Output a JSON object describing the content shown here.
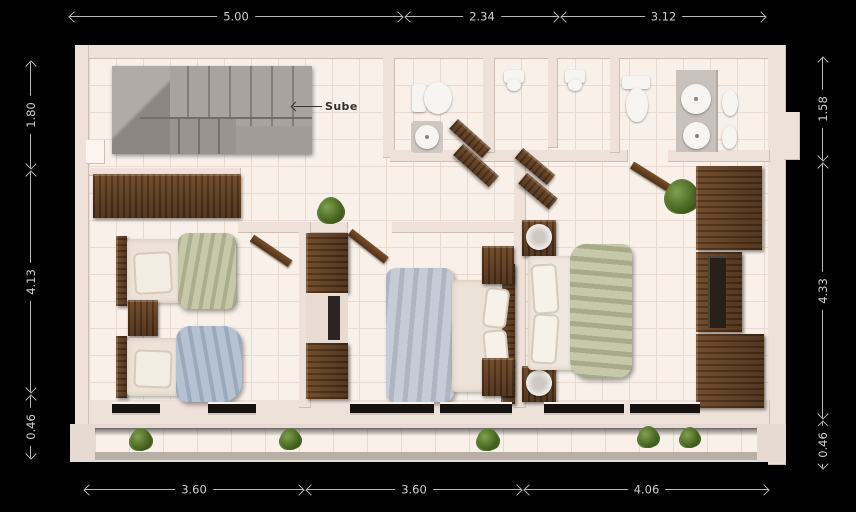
{
  "drawing": {
    "type": "floor-plan-render",
    "floor_label": "upper floor (3 bedrooms, 3 baths, stairs)",
    "stairs_label": "Sube"
  },
  "dims": {
    "top": [
      "5.00",
      "2.34",
      "3.12"
    ],
    "bottom": [
      "3.60",
      "3.60",
      "4.06"
    ],
    "left": [
      "1.80",
      "4.13",
      "0.46"
    ],
    "right": [
      "1.58",
      "4.33",
      "0.46"
    ]
  },
  "colors": {
    "background": "#000000",
    "wall": "#eee1da",
    "floor_tile": "#f8f0e9",
    "wood": "#5a3a22",
    "stairs": "#a39b95",
    "dimension_line": "#b9b9b9",
    "blanket_green": "#c7c7a9",
    "blanket_blue": "#b5c2d3",
    "duvet_gray": "#c5ccd6",
    "plant_green": "#46631f"
  }
}
